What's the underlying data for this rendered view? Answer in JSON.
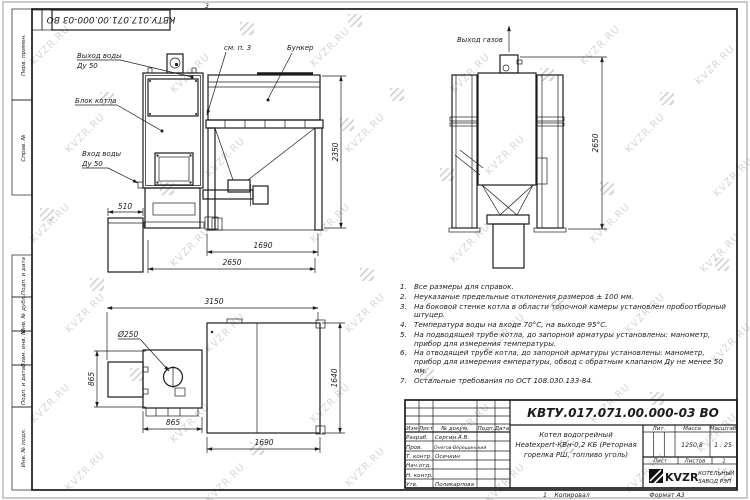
{
  "sheet": {
    "zone_marker": "3",
    "stamp": "КВТУ.017.071.00.000-03 ВО"
  },
  "watermark": {
    "text": "KVZR.RU"
  },
  "margin_labels": {
    "perv": "Перв. примен.",
    "sprav": "Справ. №",
    "podp1": "Подп. и дата",
    "inv_dubl": "Инв. № дубл.",
    "vzam": "Взам. инв. №",
    "podp2": "Подп. и дата",
    "inv_podl": "Инв. № подл."
  },
  "labels": {
    "vyhod_vody": "Выход воды",
    "du50_out": "Ду 50",
    "blok_kotla": "Блок котла",
    "vhod_vody": "Вход воды",
    "du50_in": "Ду 50",
    "sm_p3": "см. п. 3",
    "bunker": "Бункер",
    "vyhod_gazov": "Выход газов"
  },
  "dims": {
    "d510": "510",
    "d2350": "2350",
    "d1690_side": "1690",
    "d2650_side": "2650",
    "d2650_rear": "2650",
    "d3150": "3150",
    "d250": "Ø250",
    "d865_left": "865",
    "d865_bottom": "865",
    "d1640": "1640",
    "d1690_top": "1690"
  },
  "notes": {
    "items": [
      {
        "num": "1.",
        "text": "Все размеры для справок."
      },
      {
        "num": "2.",
        "text": "Неуказаные предельные отклонения размеров ± 100 мм."
      },
      {
        "num": "3.",
        "text": "На боковой стенке котла в области топочной камеры установлен пробоотборный штуцер."
      },
      {
        "num": "4.",
        "text": "Температура воды на входе 70°С, на выходе 95°С."
      },
      {
        "num": "5.",
        "text": "На подводящей трубе котла, до запорной арматуры установлены: манометр, прибор для измерения температуры."
      },
      {
        "num": "6.",
        "text": "На отводящей трубе котла, до запорной арматуры установлены: манометр, прибор для измерения емпературы, обвод с обратным клапаном Ду не менее 50 мм."
      },
      {
        "num": "7.",
        "text": "Остальные требования по ОСТ 108.030.133-84."
      }
    ]
  },
  "titleblock": {
    "designation": "КВТУ.017.071.00.000-03 ВО",
    "name_line1": "Котел водогрейный",
    "name_line2": "Heatexpert-КВн-0,2 КБ (Реторная",
    "name_line3": "горелка РШ, топливо уголь)",
    "header_cols": [
      "Изм",
      "Лист",
      "№ докум.",
      "Подп.",
      "Дата"
    ],
    "rows": [
      {
        "role": "Разраб.",
        "name": "Сергин А.В."
      },
      {
        "role": "Пров.",
        "name": "Онегов-Верещинский"
      },
      {
        "role": "Т. контр.",
        "name": "Осечкин"
      },
      {
        "role": "Нач.отд.",
        "name": ""
      },
      {
        "role": "Н. контр.",
        "name": ""
      },
      {
        "role": "Утв.",
        "name": "Поликарпова"
      }
    ],
    "lit_label": "Лит.",
    "mass_label": "Масса",
    "scale_label": "Масштаб",
    "mass_value": "1250,8",
    "scale_value": "1 : 25",
    "sheet_label": "Лист",
    "sheets_label": "Листов",
    "sheets_value": "1",
    "logo_text": "KVZR",
    "company_line1": "КОТЕЛЬНЫЙ",
    "company_line2": "ЗАВОД РЭП"
  },
  "footer": {
    "sheet_num": "1",
    "copied": "Копировал",
    "format": "Формат А3"
  }
}
